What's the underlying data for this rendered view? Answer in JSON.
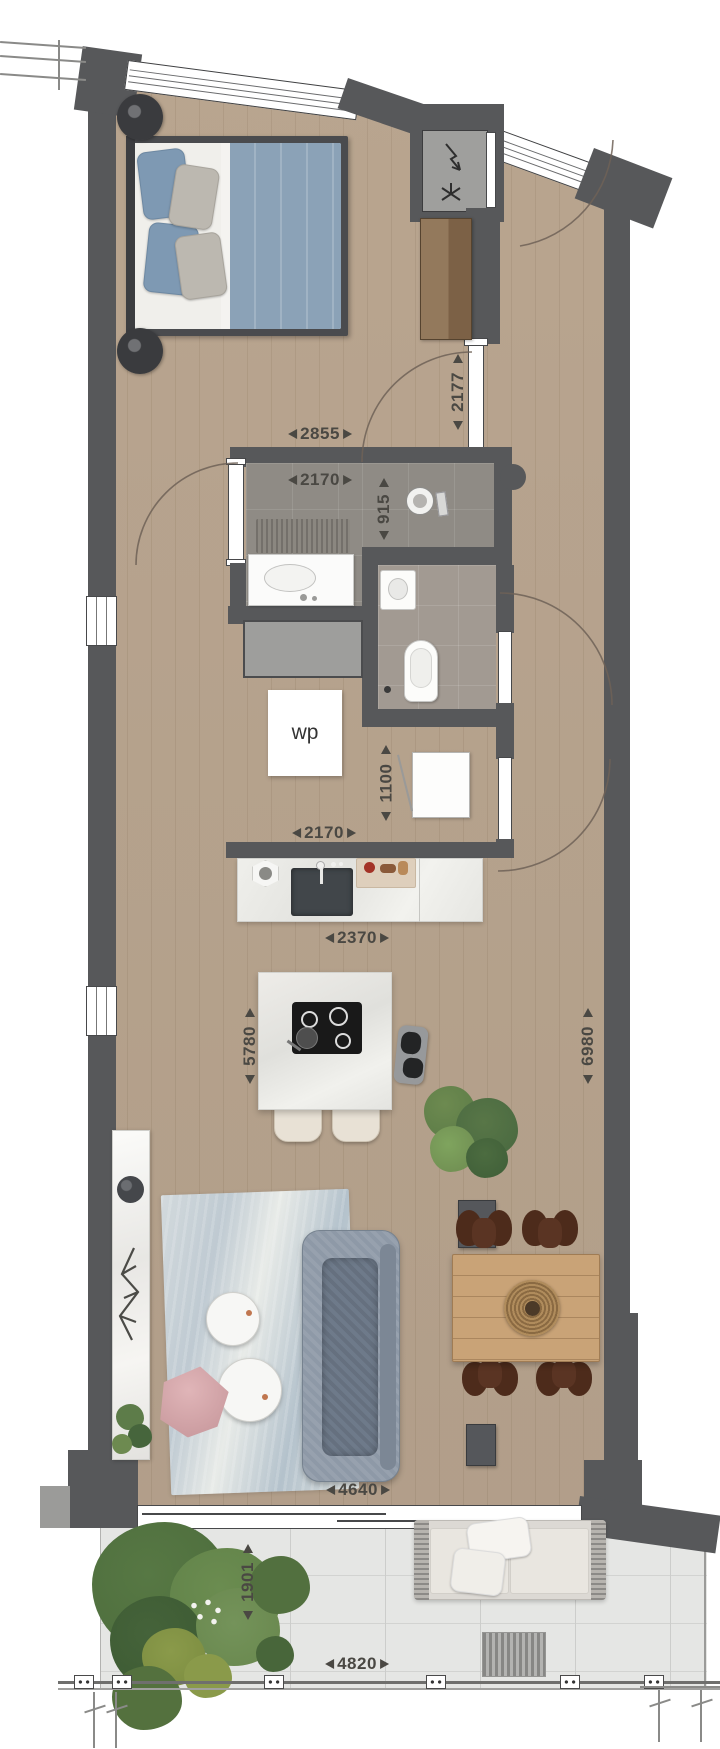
{
  "meta": {
    "type": "apartment-floor-plan",
    "unit": "mm"
  },
  "labels": {
    "heat_pump": "wp"
  },
  "dimensions": {
    "entry_hall_width": "2177",
    "bathroom_outer_width": "2855",
    "bathroom_inner_width": "2170",
    "bathroom_depth": "915",
    "utility_nook_depth": "1100",
    "utility_nook_width": "2170",
    "kitchen_counter_width": "2370",
    "living_length_left": "5780",
    "living_length_right": "6980",
    "living_width": "4640",
    "balcony_depth": "1901",
    "balcony_width": "4820"
  },
  "colors": {
    "wall": "#57585a",
    "wood_floor": "#d8ccbe",
    "bathroom_tile": "#8f8b85",
    "toilet_tile": "#a29a92",
    "balcony_floor": "#e5e6e4",
    "bed_blanket": "#8ba2b7",
    "sofa": "#8e99a7",
    "pouf_pink": "#cc9da1",
    "dining_table": "#c9a377",
    "plant_green": "#5a7a46",
    "dimension_text": "#4a4843"
  },
  "objects": [
    "double-bed",
    "bedside-tables",
    "wardrobe",
    "meter-cupboard",
    "entry-door",
    "shower",
    "washbasin-vanity",
    "toilet",
    "corner-sink",
    "laundry-space",
    "heat-pump-unit",
    "appliance",
    "kitchen-counter-with-sink",
    "kitchen-island-cooktop",
    "bar-stools",
    "sofa",
    "rug",
    "round-coffee-tables",
    "pink-pouf",
    "sideboard",
    "dining-table",
    "dining-chairs",
    "indoor-plants",
    "balcony-plants",
    "outdoor-sofa",
    "balcony-railing"
  ]
}
